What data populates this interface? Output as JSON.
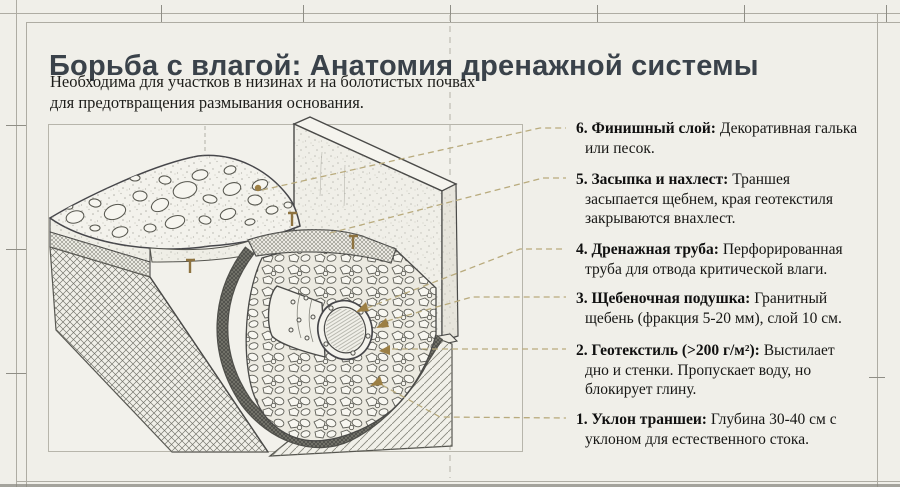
{
  "header": {
    "title": "Борьба с влагой: Анатомия дренажной системы",
    "subtitle_line1": "Необходима для участков в низинах и на болотистых почвах",
    "subtitle_line2": "для предотвращения размывания основания."
  },
  "legend": {
    "items": [
      {
        "label": "6. Финишный слой:",
        "desc": "Декоративная галька или песок."
      },
      {
        "label": "5. Засыпка и нахлест:",
        "desc": "Траншея засыпается щебнем, края геотекстиля закрываются внахлест."
      },
      {
        "label": "4. Дренажная труба:",
        "desc": "Перфорированная труба для отвода критической влаги."
      },
      {
        "label": "3. Щебеночная подушка:",
        "desc": "Гранитный щебень (фракция 5-20 мм), слой 10 см."
      },
      {
        "label": "2. Геотекстиль (>200 г/м²):",
        "desc": "Выстилает дно и стенки. Пропускает воду, но блокирует глину."
      },
      {
        "label": "1. Уклон траншеи:",
        "desc": "Глубина 30-40 см с уклоном для естественного стока."
      }
    ]
  },
  "diagram": {
    "name": "drainage-trench-isometric-cutaway"
  },
  "colors": {
    "background": "#f0efe9",
    "title_text": "#3a424a",
    "body_text": "#161614",
    "leader_line_tan": "#b9ab7d",
    "marker_brown": "#9c7f44",
    "diagram_ink": "#4a4a48",
    "frame_line": "#b5b3a9"
  }
}
